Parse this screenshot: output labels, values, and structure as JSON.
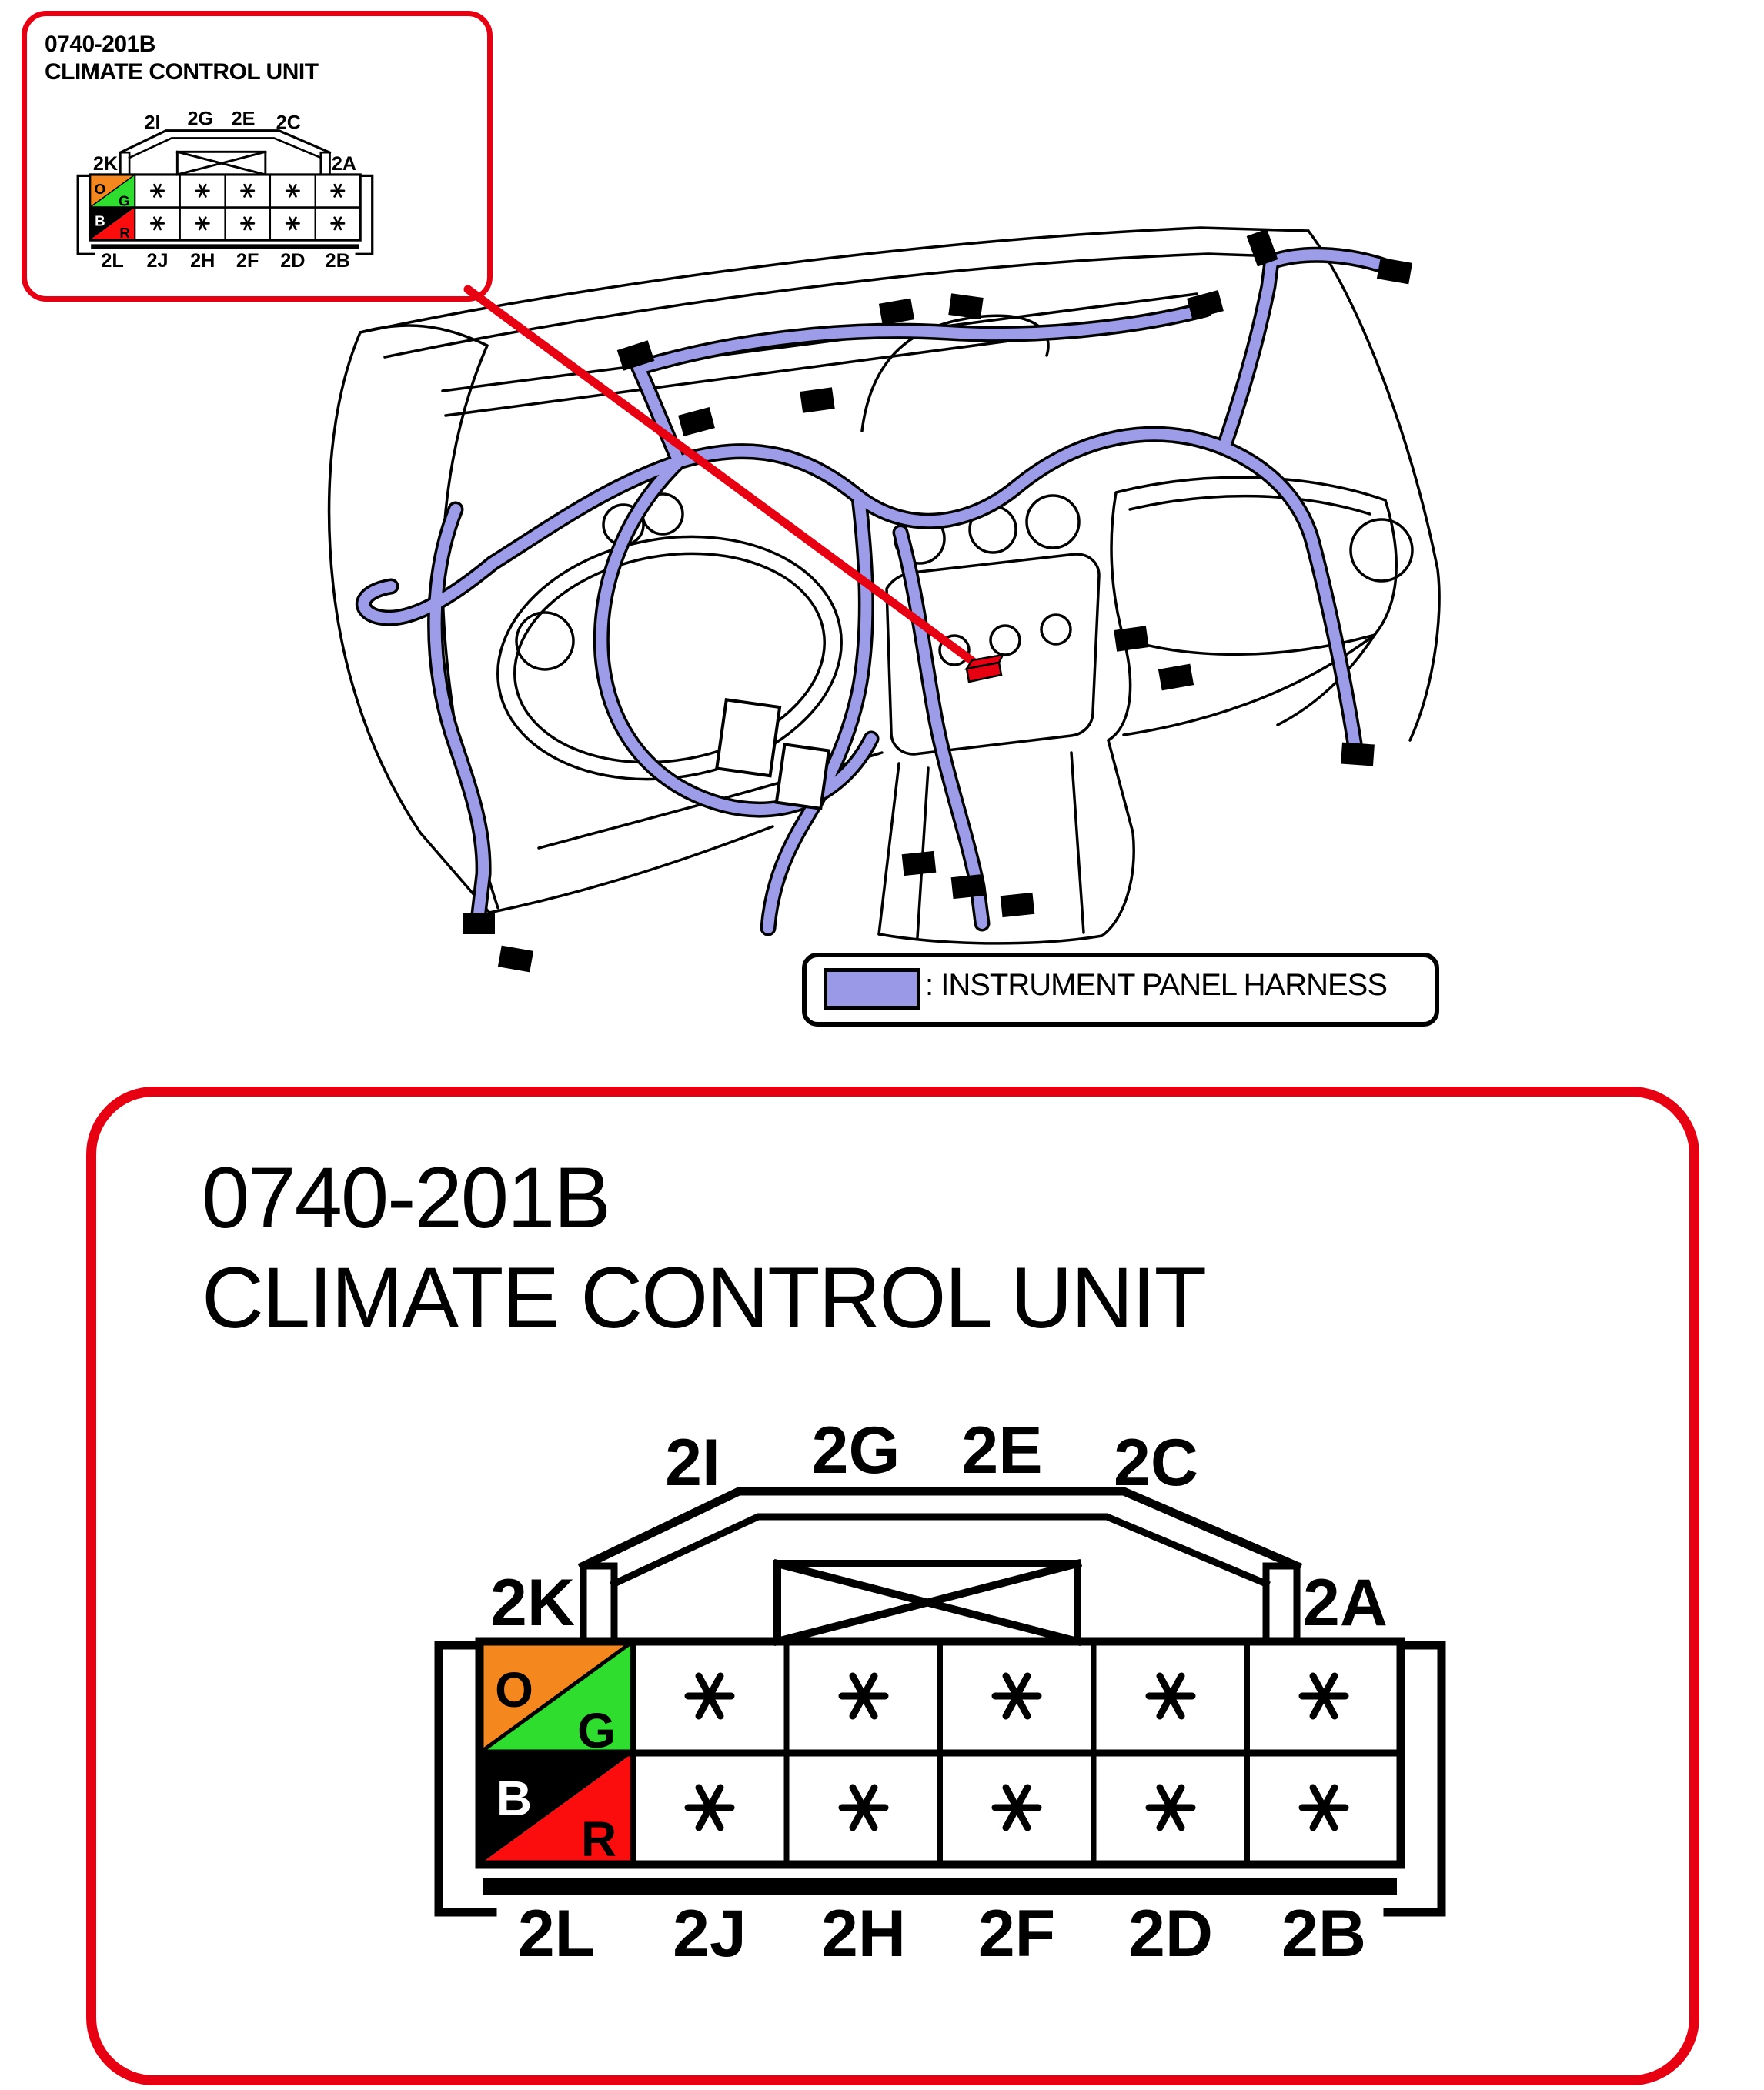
{
  "inset_callout": {
    "code": "0740-201B",
    "name": "CLIMATE CONTROL UNIT"
  },
  "detail_panel": {
    "code": "0740-201B",
    "name": "CLIMATE CONTROL UNIT"
  },
  "legend": {
    "label": ": INSTRUMENT PANEL HARNESS",
    "swatch_color": "#9999e8"
  },
  "connector": {
    "top_labels": [
      "2I",
      "2G",
      "2E",
      "2C"
    ],
    "side_labels": {
      "left": "2K",
      "right": "2A"
    },
    "bottom_labels": [
      "2L",
      "2J",
      "2H",
      "2F",
      "2D",
      "2B"
    ],
    "color_cells": [
      {
        "letter": "O",
        "color": "#f5871f",
        "text_color": "#000000"
      },
      {
        "letter": "G",
        "color": "#2fdd2f",
        "text_color": "#000000"
      },
      {
        "letter": "B",
        "color": "#000000",
        "text_color": "#ffffff"
      },
      {
        "letter": "R",
        "color": "#fb0d0d",
        "text_color": "#000000"
      }
    ],
    "pin_symbol": "✱"
  },
  "colors": {
    "highlight_red": "#e60012",
    "harness_purple": "#9c9ce8",
    "outline_black": "#000000"
  }
}
